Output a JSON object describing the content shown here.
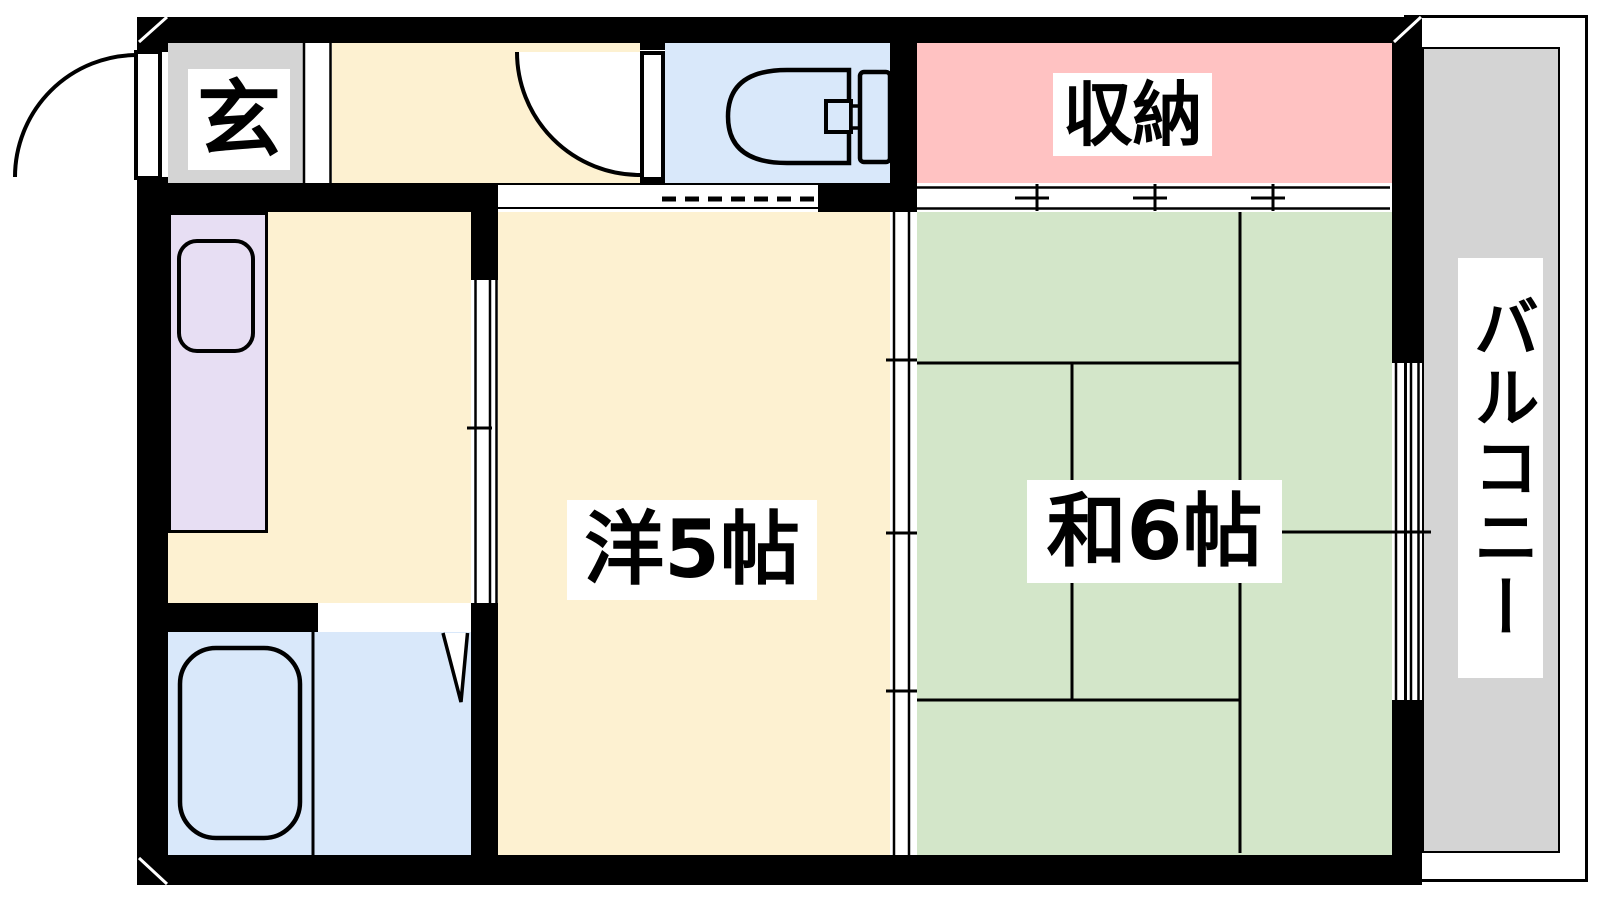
{
  "title": "1K apartment floor plan",
  "rooms": {
    "genkan": {
      "label": "玄",
      "name": "entrance"
    },
    "storage": {
      "label": "収納",
      "name": "closet"
    },
    "western_room": {
      "label": "洋5帖",
      "name": "western-style room 5 mats"
    },
    "japanese_room": {
      "label": "和6帖",
      "name": "japanese-style room 6 mats"
    },
    "balcony": {
      "label": "バルコニー",
      "name": "balcony"
    }
  },
  "tatami_count": 6,
  "fixtures": [
    "entrance-door",
    "hallway-door",
    "toilet",
    "kitchen-counter",
    "kitchen-sink",
    "bathtub",
    "bath-folding-door",
    "closet-sliding-doors",
    "room-sliding-partition",
    "kitchen-sliding-door",
    "balcony-window"
  ],
  "colors": {
    "wall": "#000000",
    "flooring": "#fdf1d1",
    "tatami": "#d3e6c9",
    "storage": "#ffc2c2",
    "wet_area": "#d9e8fa",
    "kitchen_counter": "#e7def3",
    "concrete": "#d4d4d4",
    "label_background": "#ffffff"
  }
}
